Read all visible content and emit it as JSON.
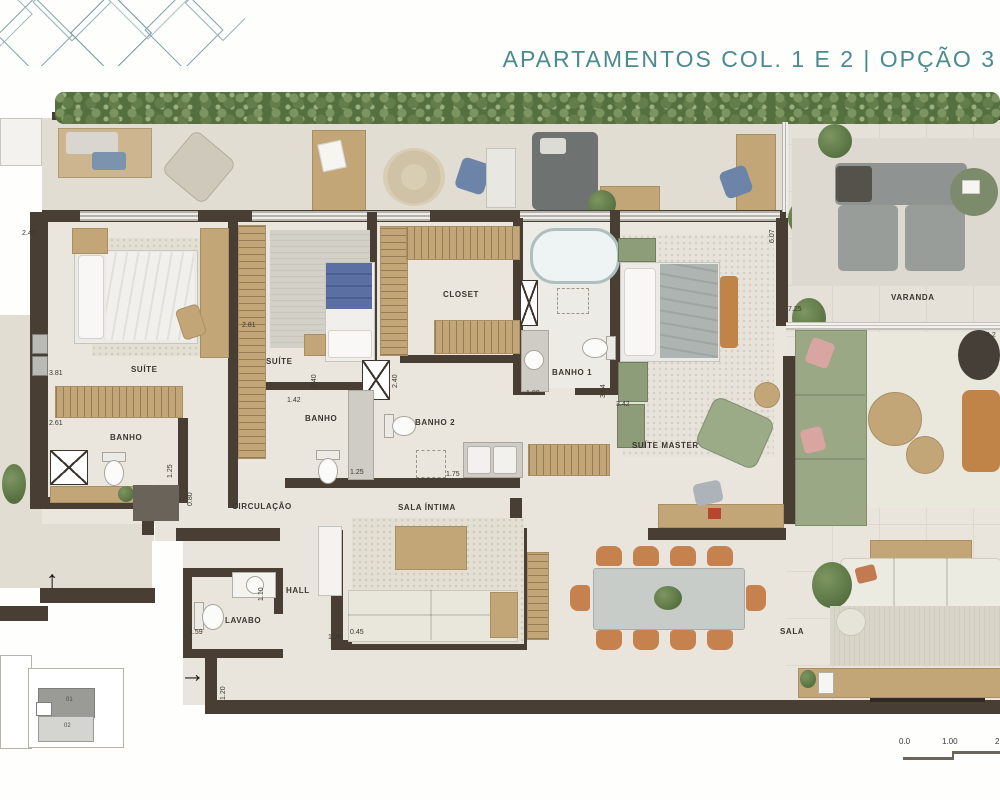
{
  "header": {
    "title": "APARTAMENTOS COL. 1 E 2 | OPÇÃO 3"
  },
  "colors": {
    "title_teal": "#4b8a8e",
    "wall": "#483e34",
    "floor": "#e9e5dc",
    "terrace_floor": "#e2ddd3",
    "wood": "#c2a678",
    "hedge_green": "#5f7a4c",
    "sofa_green": "#9aa885",
    "chair_terracotta": "#c5824f",
    "accent_blue": "#5b6fa3"
  },
  "plan": {
    "rooms": {
      "suite1": "SUÍTE",
      "banho_esq": "BANHO",
      "suite2": "SUÍTE",
      "closet": "CLOSET",
      "banho_meio": "BANHO",
      "banho2": "BANHO 2",
      "banho1": "BANHO 1",
      "suite_master": "SUÍTE MASTER",
      "varanda": "VARANDA",
      "circulacao": "CIRCULAÇÃO",
      "sala_intima": "SALA ÍNTIMA",
      "hall": "HALL",
      "lavabo": "LAVABO",
      "sala": "SALA"
    },
    "dims": {
      "d_240_top": "2.40",
      "d_381": "3.81",
      "d_261": "2.61",
      "d_281": "2.81",
      "d_142": "1.42",
      "d_240_a": "2.40",
      "d_240_b": "2.40",
      "d_125_a": "1.25",
      "d_080": "0.80",
      "d_125_b": "1.25",
      "d_175": "1.75",
      "d_180": "1.80",
      "d_354": "3.54",
      "d_342": "3.42",
      "d_607": "6.07",
      "d_725": "7.25",
      "d_42": "4.2",
      "d_159": "1.59",
      "d_110": "1.10",
      "d_120": "1.20",
      "d_136": "1.36",
      "d_045": "0.45"
    },
    "arrows": {
      "up": "↑",
      "entry": "→"
    },
    "keyplan": {
      "unit_top": "01",
      "unit_bottom": "02"
    },
    "scale_bar": {
      "t0": "0.0",
      "t1": "1.00",
      "t2": "2"
    }
  }
}
